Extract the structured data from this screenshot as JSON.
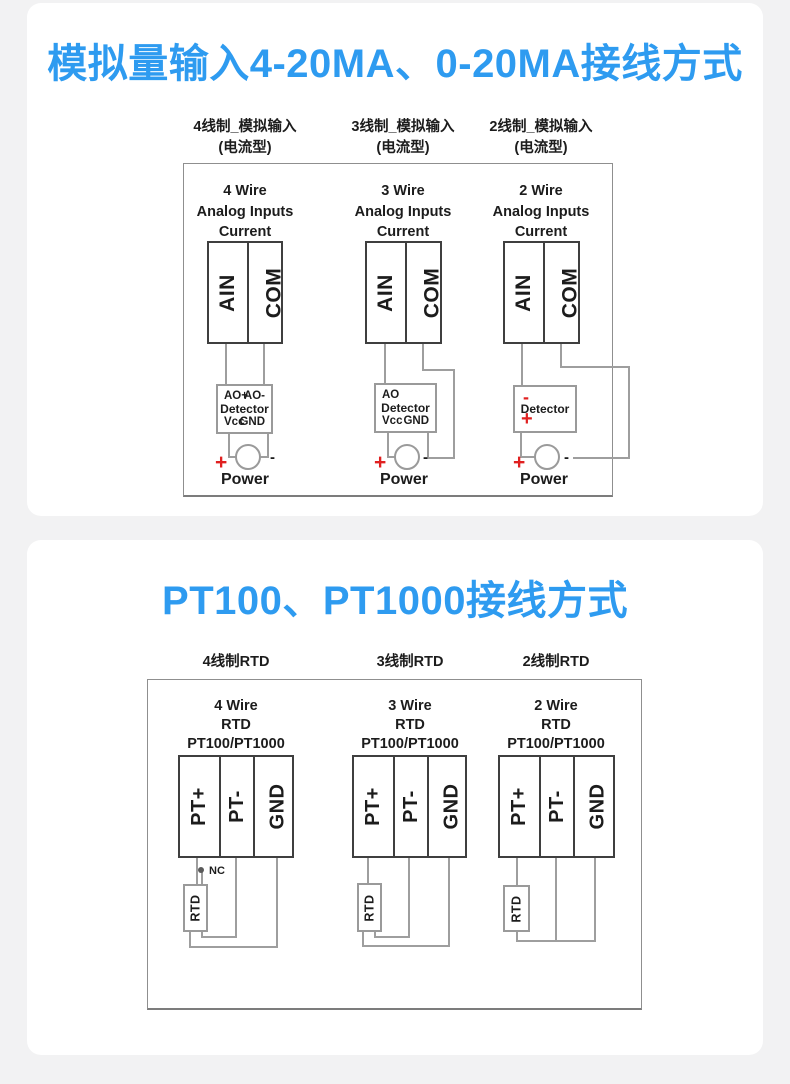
{
  "colors": {
    "accent_blue": "#2e9bf0",
    "wire_gray": "#9e9e9e",
    "terminal_border": "#3f3f3f",
    "red": "#e02020",
    "page_background": "#f2f2f3",
    "card_background": "#ffffff"
  },
  "section1": {
    "title": "模拟量输入4-20MA、0-20MA接线方式",
    "columns": [
      {
        "header_line1": "4线制_模拟输入",
        "header_line2": "(电流型)",
        "diagram_title": [
          "4 Wire",
          "Analog Inputs",
          "Current"
        ],
        "terminal_left": "AIN",
        "terminal_right": "COM",
        "detector": {
          "top_left": "AO+",
          "top_right": "AO-",
          "name": "Detector",
          "bottom_left": "Vcc",
          "bottom_right": "GND"
        },
        "power": {
          "plus": "+",
          "minus": "-",
          "label": "Power"
        }
      },
      {
        "header_line1": "3线制_模拟输入",
        "header_line2": "(电流型)",
        "diagram_title": [
          "3 Wire",
          "Analog Inputs",
          "Current"
        ],
        "terminal_left": "AIN",
        "terminal_right": "COM",
        "detector": {
          "top_left": "AO",
          "name": "Detector",
          "bottom_left": "Vcc",
          "bottom_right": "GND"
        },
        "power": {
          "plus": "+",
          "minus": "-",
          "label": "Power"
        }
      },
      {
        "header_line1": "2线制_模拟输入",
        "header_line2": "(电流型)",
        "diagram_title": [
          "2 Wire",
          "Analog Inputs",
          "Current"
        ],
        "terminal_left": "AIN",
        "terminal_right": "COM",
        "detector": {
          "top_left": "-",
          "name": "Detector",
          "bottom_left": "+"
        },
        "power": {
          "plus": "+",
          "minus": "-",
          "label": "Power"
        }
      }
    ]
  },
  "section2": {
    "title": "PT100、PT1000接线方式",
    "columns": [
      {
        "header": "4线制RTD",
        "diagram_title": [
          "4 Wire",
          "RTD",
          "PT100/PT1000"
        ],
        "terminals": [
          "PT+",
          "PT-",
          "GND"
        ],
        "rtd_label": "RTD",
        "nc_label": "NC"
      },
      {
        "header": "3线制RTD",
        "diagram_title": [
          "3 Wire",
          "RTD",
          "PT100/PT1000"
        ],
        "terminals": [
          "PT+",
          "PT-",
          "GND"
        ],
        "rtd_label": "RTD"
      },
      {
        "header": "2线制RTD",
        "diagram_title": [
          "2 Wire",
          "RTD",
          "PT100/PT1000"
        ],
        "terminals": [
          "PT+",
          "PT-",
          "GND"
        ],
        "rtd_label": "RTD"
      }
    ]
  }
}
